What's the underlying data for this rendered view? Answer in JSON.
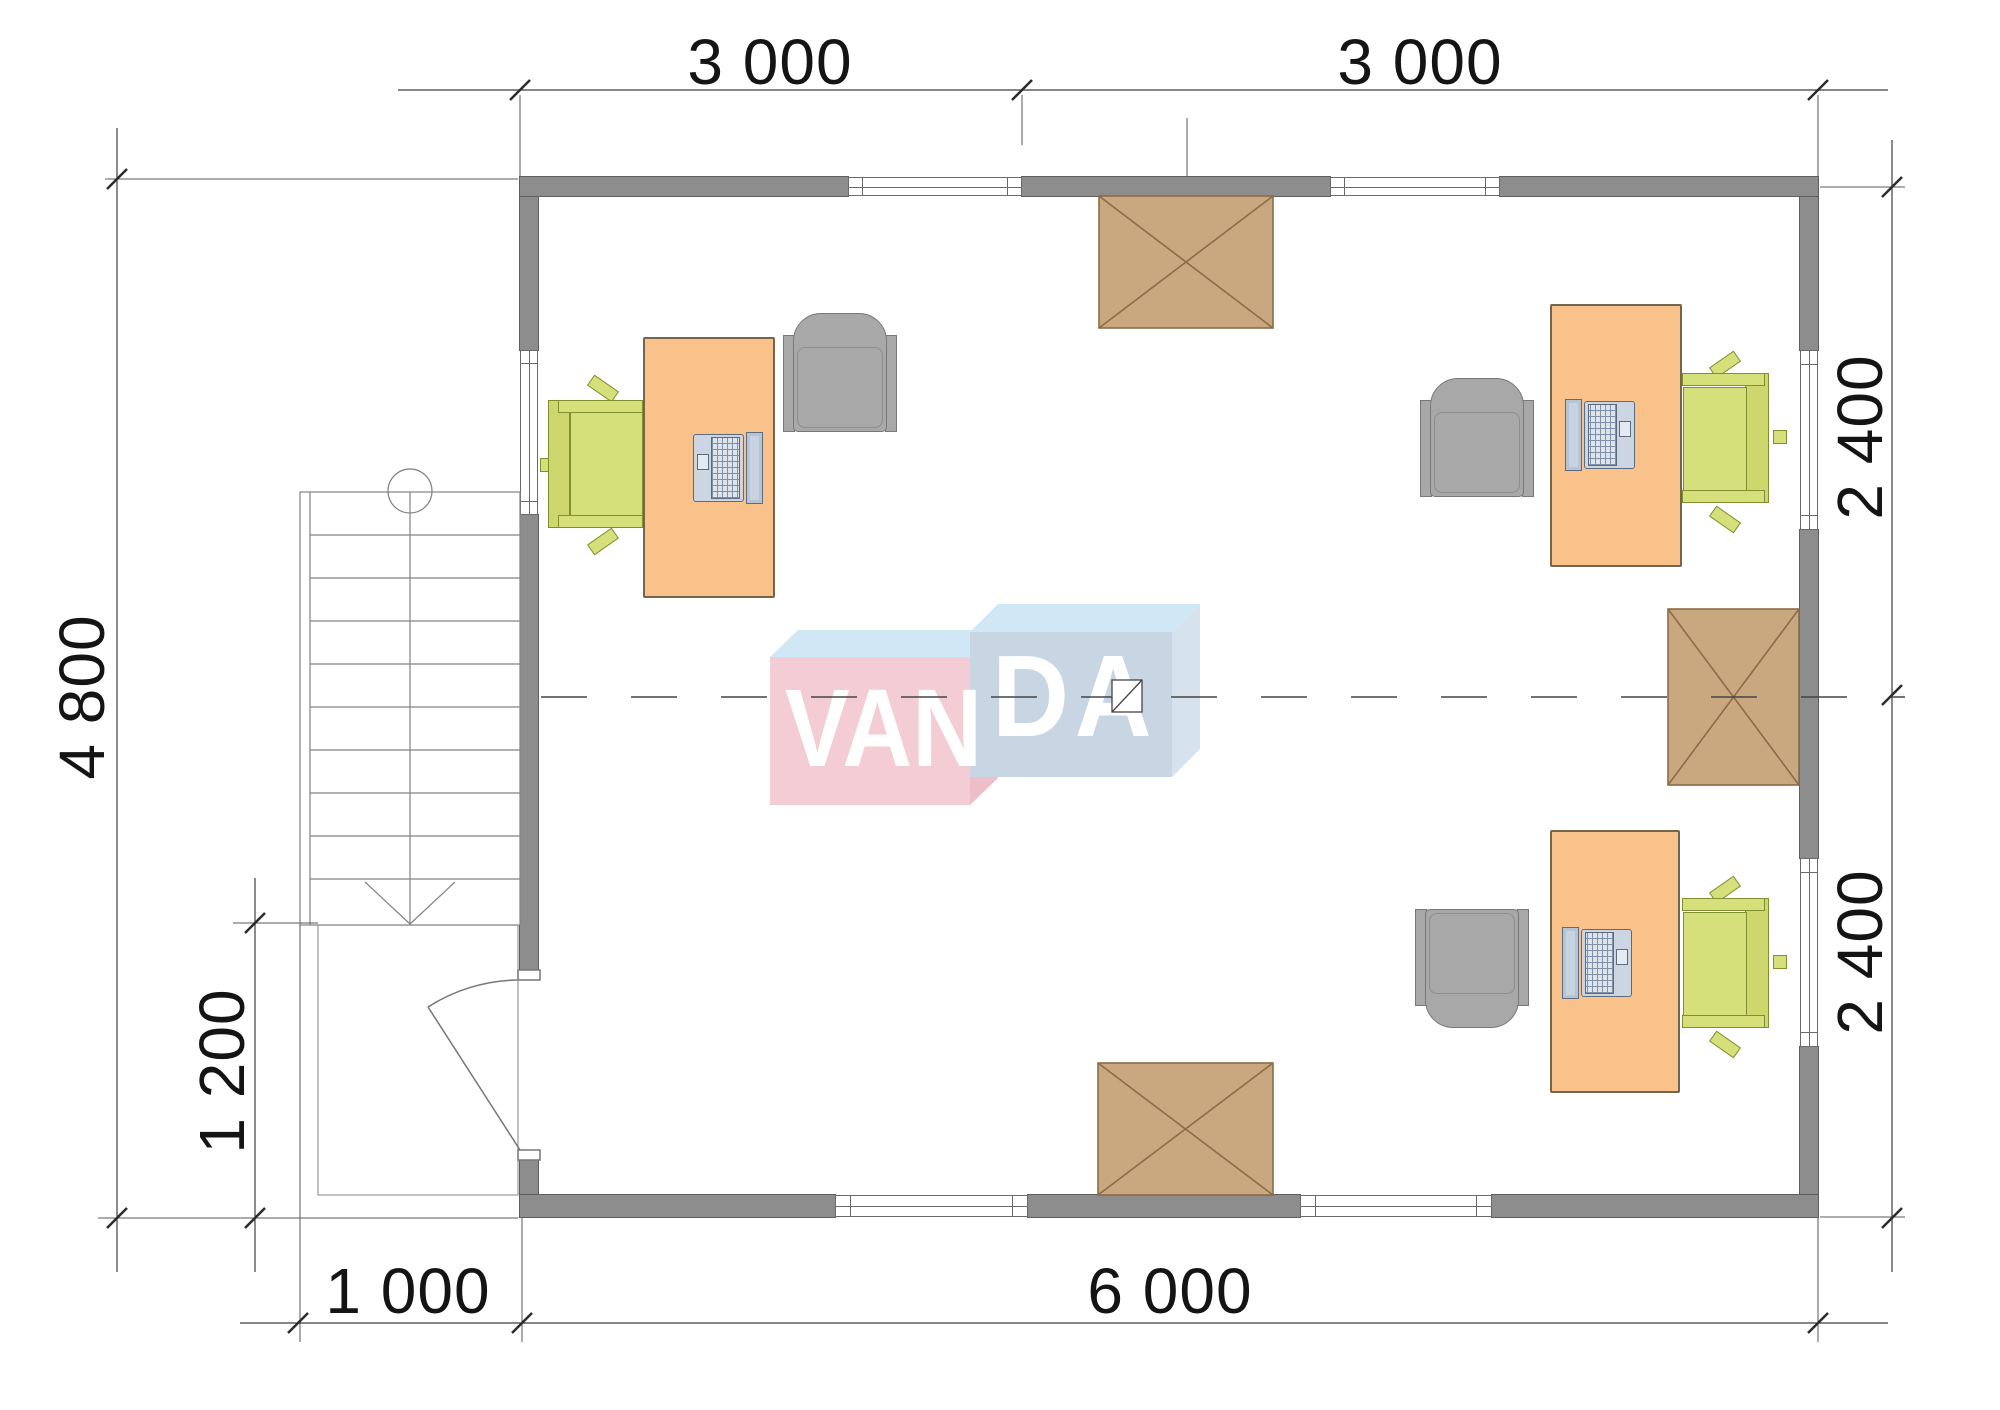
{
  "title": "Office floor plan with VANDA watermark",
  "dimensions": {
    "top_left": "3 000",
    "top_right": "3 000",
    "left_height": "4 800",
    "porch_height": "1 200",
    "porch_width": "1 000",
    "bottom_width": "6 000",
    "right_upper": "2 400",
    "right_lower": "2 400"
  },
  "logo": {
    "left": "VAN",
    "right": "DA"
  },
  "furniture": [
    {
      "name": "workstation-1",
      "items": [
        "desk",
        "green-office-chair",
        "gray-armchair",
        "laptop"
      ]
    },
    {
      "name": "workstation-2",
      "items": [
        "desk",
        "green-office-chair",
        "gray-armchair",
        "laptop"
      ]
    },
    {
      "name": "workstation-3",
      "items": [
        "desk",
        "green-office-chair",
        "gray-armchair",
        "laptop"
      ]
    },
    {
      "name": "roof-hatch",
      "count": 3
    },
    {
      "name": "staircase-with-down-arrow",
      "count": 1
    },
    {
      "name": "entrance-door-swing",
      "count": 1
    },
    {
      "name": "window",
      "count": 7
    }
  ],
  "colors": {
    "wall": "#8d8d8d",
    "wallEdge": "#5e5e5e",
    "frame": "#6a6a6a",
    "desk": "#f9c28a",
    "deskEdge": "#75654c",
    "green": "#d6e07b",
    "greenDk": "#cdd76d",
    "greenEdge": "#7f8f31",
    "gray": "#a8a8a8",
    "grayEdge": "#787878",
    "hatch": "#c9a880",
    "hatchEdge": "#8d6b46",
    "line": "#3f3f3f",
    "tick": "#2b2b2b",
    "thin": "#5a5a5a",
    "text": "#141414",
    "logoPink": "#f4ccd3",
    "logoPinkSide": "#edbec7",
    "logoBlue": "#c8d5e3",
    "logoBlueSide": "#d6e2ee",
    "logoTop": "#d0e8f6"
  }
}
